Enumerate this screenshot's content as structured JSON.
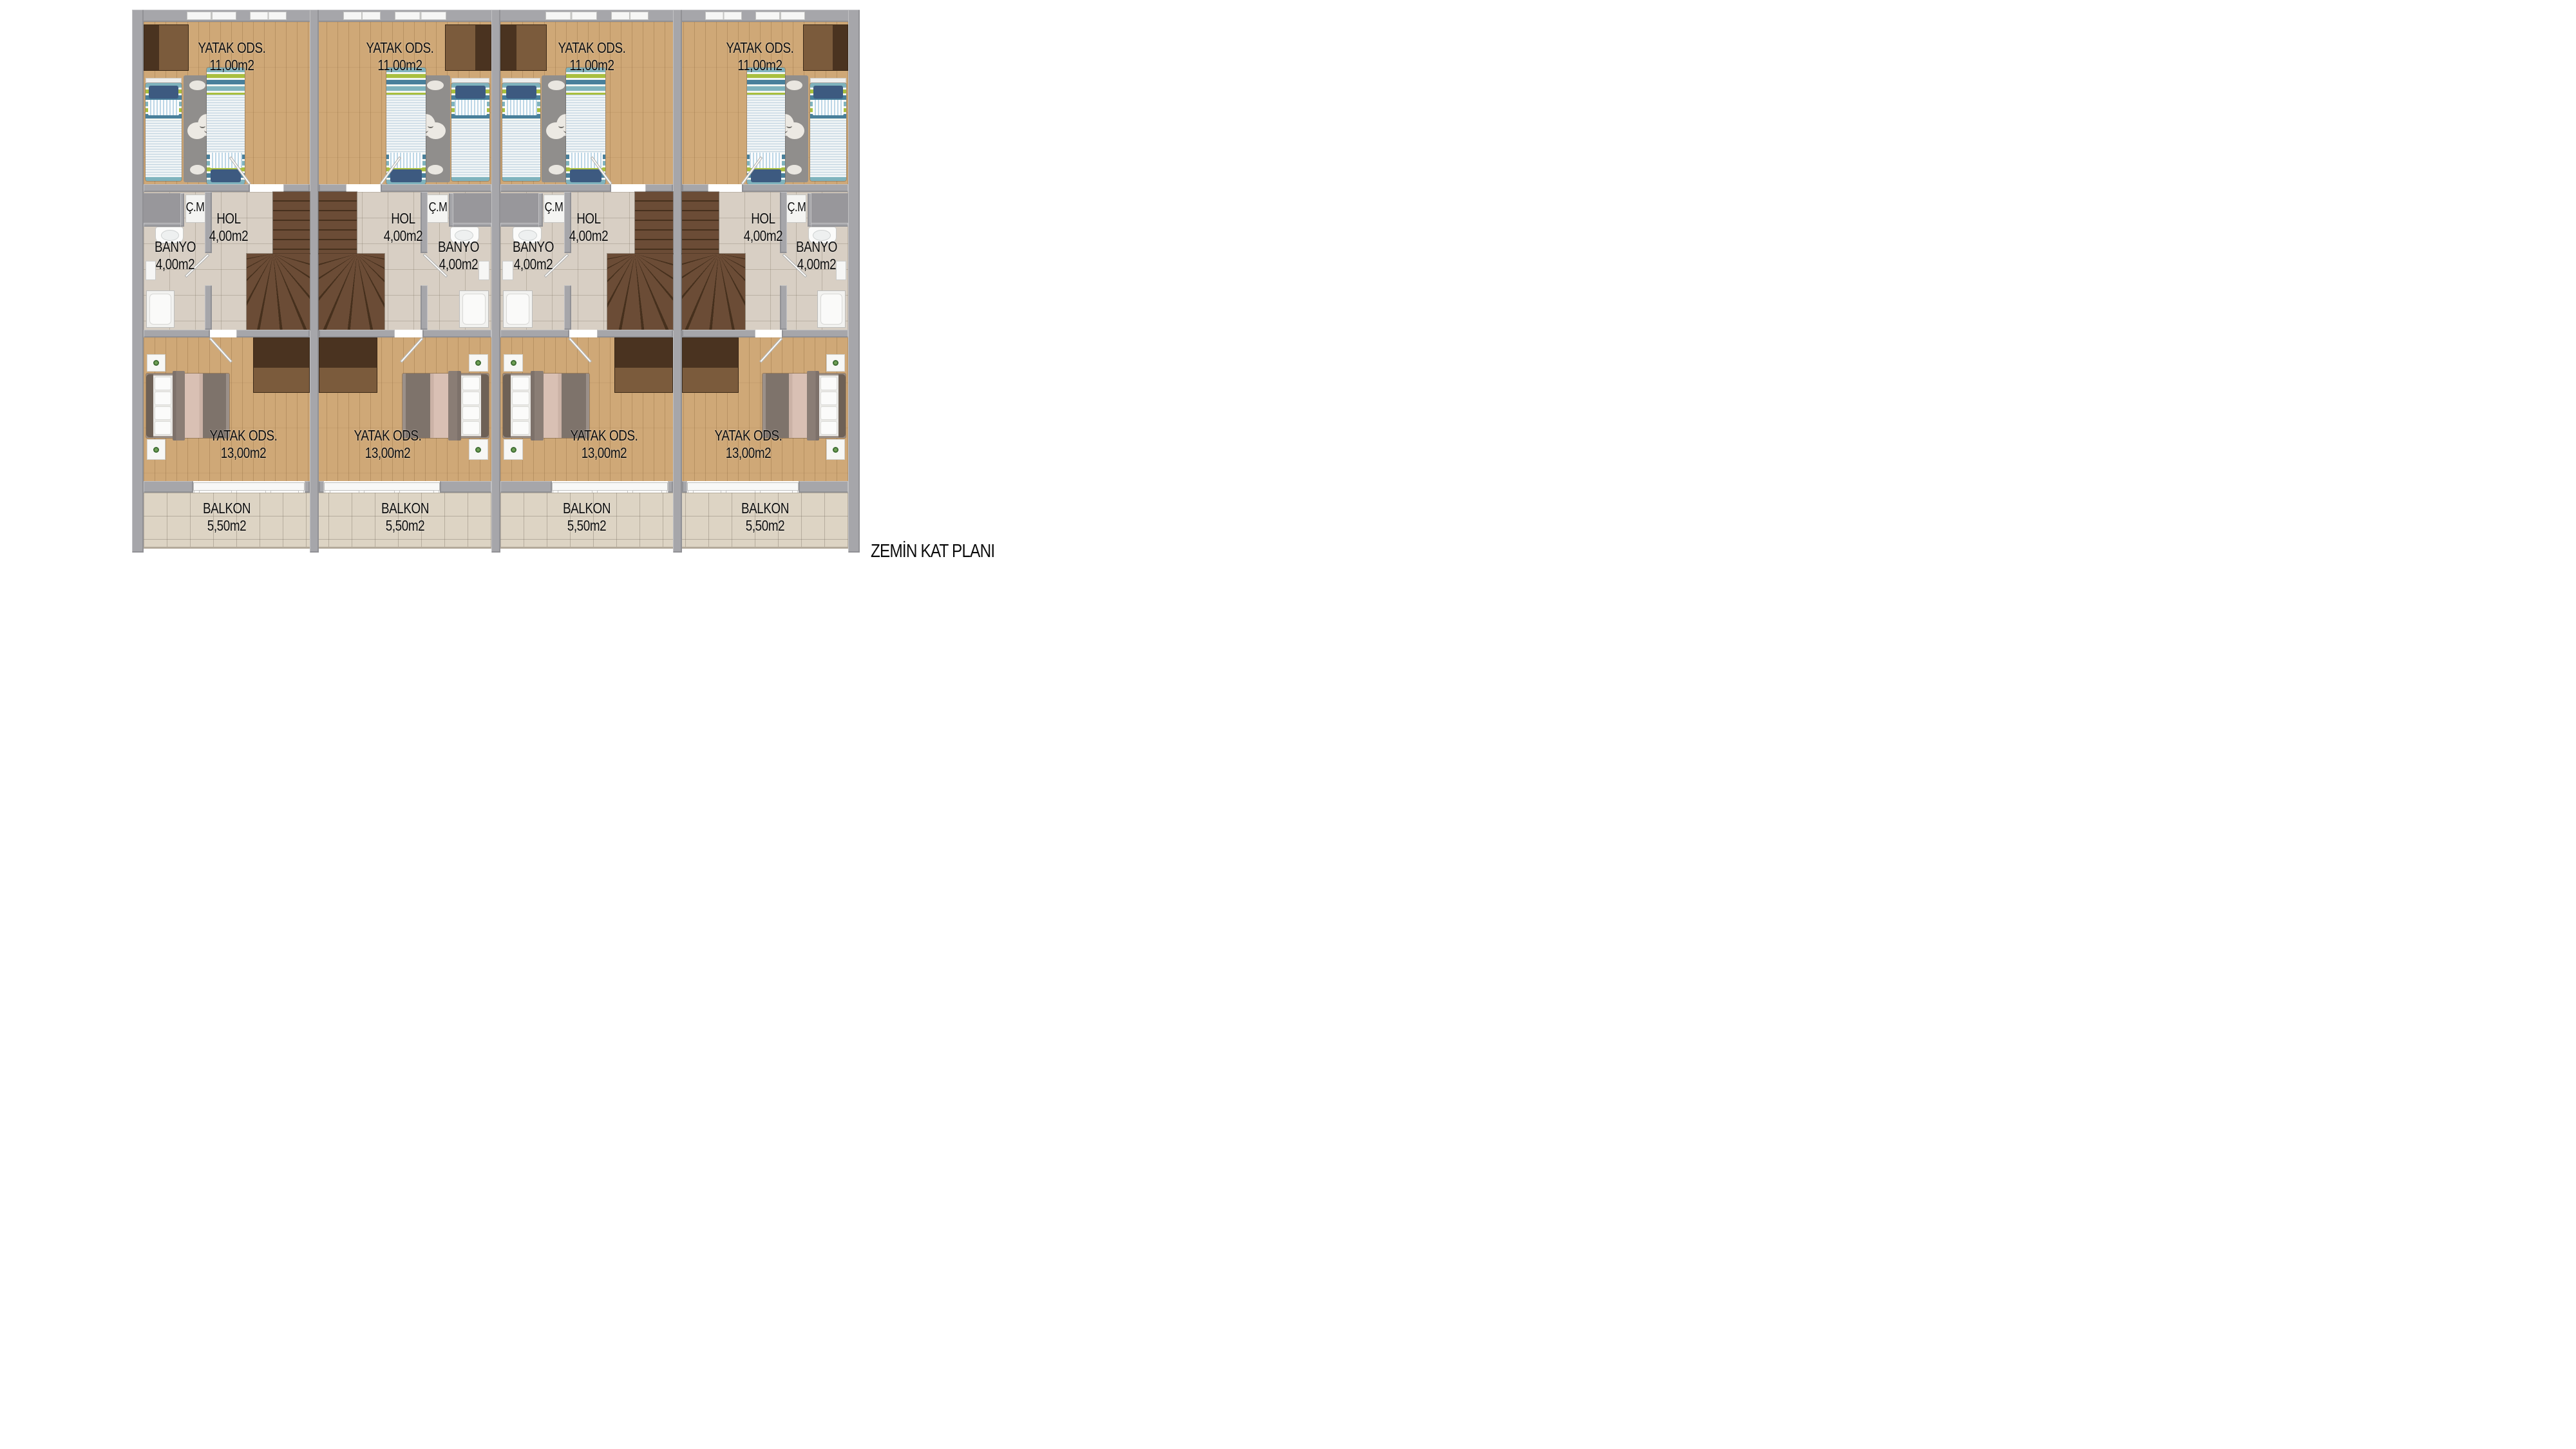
{
  "title": "ZEMİN KAT PLANI",
  "palette": {
    "wall": "#a6a6aa",
    "wood_floor": "#cfa877",
    "tile_floor": "#d8cfc4",
    "balcony_tile": "#ddd4c4",
    "stair_wood": "#6b4c36",
    "bed_stripe_teal": "#49809b",
    "bed_stripe_green": "#a9bf3e",
    "pillow_navy": "#3d5a80",
    "master_blanket_gray": "#7e736b",
    "master_throw_pink": "#d9c0b4",
    "rug_gray": "#908e8c",
    "label_text": "#0c0c0c"
  },
  "units": [
    {
      "index": 1,
      "mirrored": false,
      "rooms": {
        "bedroom_kids": {
          "name": "YATAK ODS.",
          "area": "11,00m2"
        },
        "closet": {
          "name": "Ç.M"
        },
        "hall": {
          "name": "HOL",
          "area": "4,00m2"
        },
        "bath": {
          "name": "BANYO",
          "area": "4,00m2"
        },
        "bedroom_master": {
          "name": "YATAK ODS.",
          "area": "13,00m2"
        },
        "balcony": {
          "name": "BALKON",
          "area": "5,50m2"
        }
      }
    },
    {
      "index": 2,
      "mirrored": true,
      "rooms": {
        "bedroom_kids": {
          "name": "YATAK ODS.",
          "area": "11,00m2"
        },
        "closet": {
          "name": "Ç.M"
        },
        "hall": {
          "name": "HOL",
          "area": "4,00m2"
        },
        "bath": {
          "name": "BANYO",
          "area": "4,00m2"
        },
        "bedroom_master": {
          "name": "YATAK ODS.",
          "area": "13,00m2"
        },
        "balcony": {
          "name": "BALKON",
          "area": "5,50m2"
        }
      }
    },
    {
      "index": 3,
      "mirrored": false,
      "rooms": {
        "bedroom_kids": {
          "name": "YATAK ODS.",
          "area": "11,00m2"
        },
        "closet": {
          "name": "Ç.M"
        },
        "hall": {
          "name": "HOL",
          "area": "4,00m2"
        },
        "bath": {
          "name": "BANYO",
          "area": "4,00m2"
        },
        "bedroom_master": {
          "name": "YATAK ODS.",
          "area": "13,00m2"
        },
        "balcony": {
          "name": "BALKON",
          "area": "5,50m2"
        }
      }
    },
    {
      "index": 4,
      "mirrored": true,
      "rooms": {
        "bedroom_kids": {
          "name": "YATAK ODS.",
          "area": "11,00m2"
        },
        "closet": {
          "name": "Ç.M"
        },
        "hall": {
          "name": "HOL",
          "area": "4,00m2"
        },
        "bath": {
          "name": "BANYO",
          "area": "4,00m2"
        },
        "bedroom_master": {
          "name": "YATAK ODS.",
          "area": "13,00m2"
        },
        "balcony": {
          "name": "BALKON",
          "area": "5,50m2"
        }
      }
    }
  ]
}
